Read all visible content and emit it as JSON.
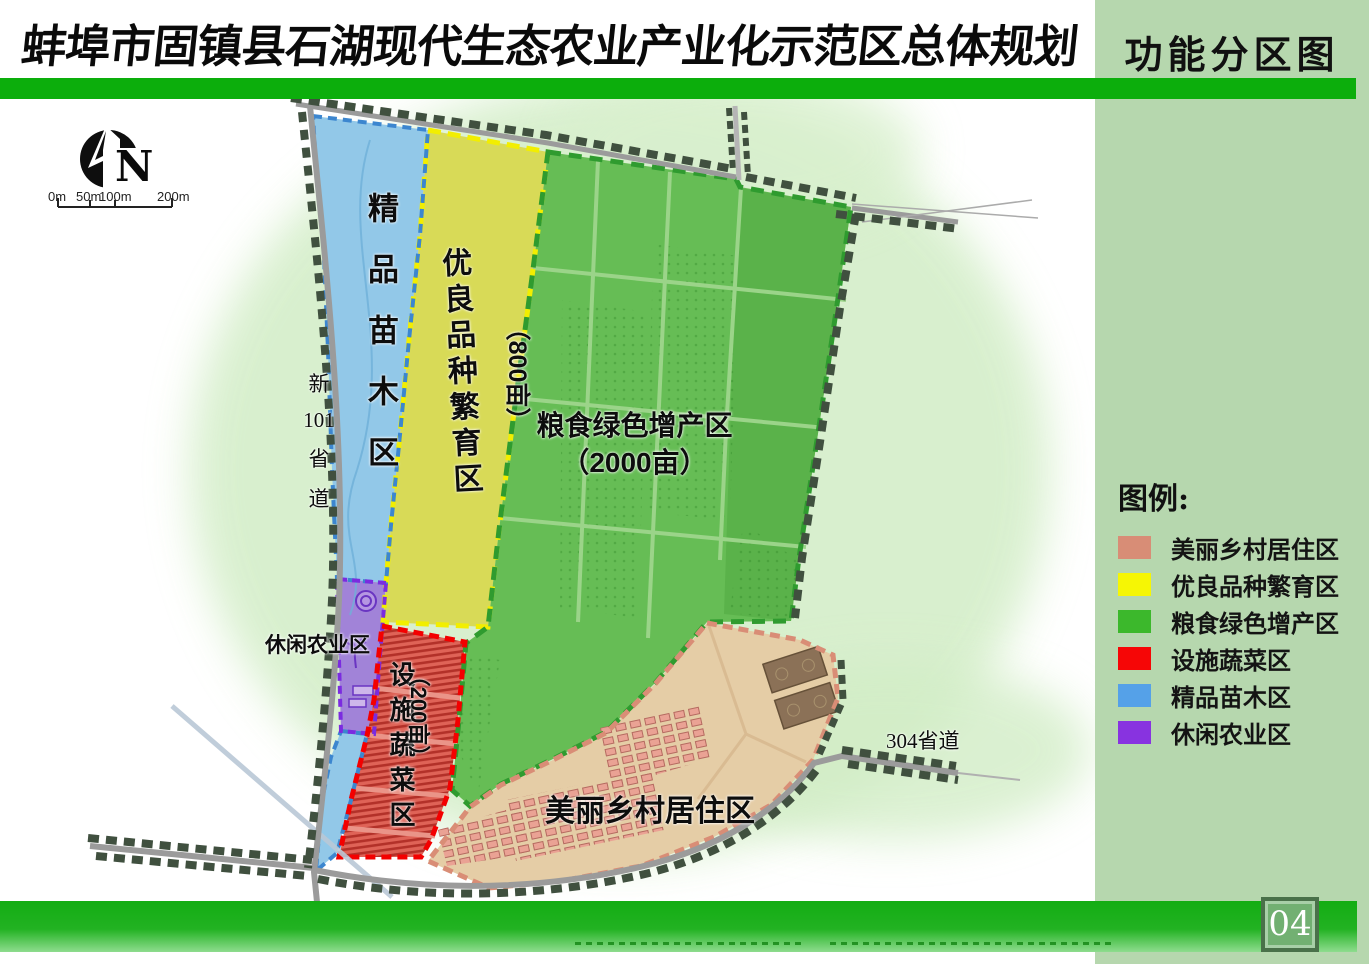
{
  "header": {
    "title": "蚌埠市固镇县石湖现代生态农业产业化示范区总体规划",
    "subtitle": "功能分区图"
  },
  "page_number": "04",
  "compass": {
    "label": "N"
  },
  "scale_bar": {
    "labels": [
      "0m",
      "50m",
      "100m",
      "200m"
    ]
  },
  "legend": {
    "title": "图例:",
    "items": [
      {
        "label": "美丽乡村居住区",
        "color": "#d88d76"
      },
      {
        "label": "优良品种繁育区",
        "color": "#f6f604"
      },
      {
        "label": "粮食绿色增产区",
        "color": "#3cb82c"
      },
      {
        "label": "设施蔬菜区",
        "color": "#f60606"
      },
      {
        "label": "精品苗木区",
        "color": "#55a1e8"
      },
      {
        "label": "休闲农业区",
        "color": "#8833e0"
      }
    ]
  },
  "map": {
    "labels": {
      "nursery": "精品苗木区",
      "breeding": "优良品种繁育区",
      "breeding_area": "（800亩）",
      "grain": "粮食绿色增产区",
      "grain_area": "（2000亩）",
      "vegetable": "设施蔬菜区",
      "vegetable_area": "（200亩）",
      "leisure": "休闲农业区",
      "village": "美丽乡村居住区",
      "road_left_1": "新",
      "road_left_2": "101",
      "road_left_3": "省",
      "road_left_4": "道",
      "road_bottom": "304省道"
    }
  }
}
